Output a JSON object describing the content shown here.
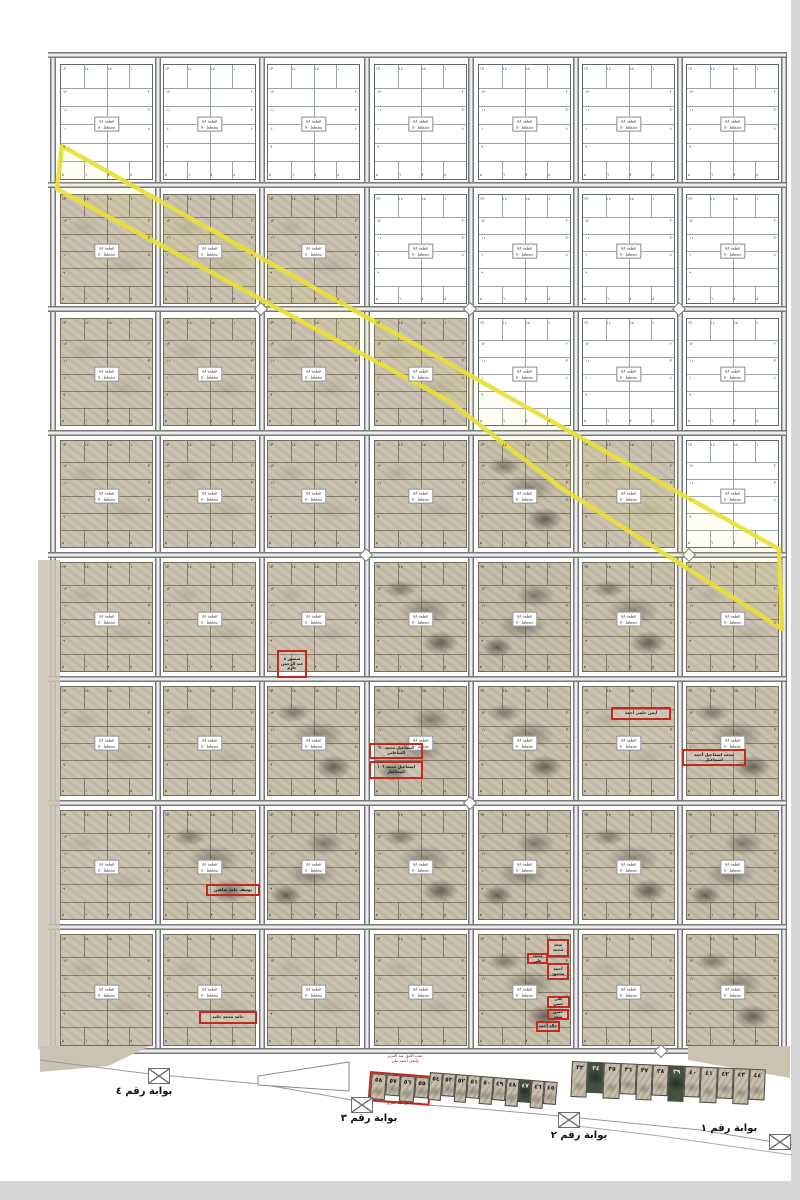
{
  "grid": {
    "rows": 8,
    "cols": 7,
    "states": [
      "wwwwwww",
      "tttwwww",
      "ttttwww",
      "ttttdtw",
      "tttdddt",
      "ttdddtd",
      "tdddddd",
      "ttttdtd"
    ]
  },
  "block_label": {
    "line1": "قطعة ٥٨",
    "line2": "مخطط ٥٠"
  },
  "block_numbers": {
    "top": [
      "١٣",
      "١٤",
      "١٥",
      "١"
    ],
    "left": [
      "١٢",
      "١١",
      "١٠",
      "٩"
    ],
    "right": [
      "٢",
      "٣",
      "٤",
      ""
    ],
    "bottom": [
      "٥",
      "٦",
      "٧",
      "٨"
    ]
  },
  "red_tags": [
    {
      "x": 277,
      "y": 650,
      "w": 30,
      "h": 28,
      "lines": [
        "منصور ٨",
        "عبد الرحمن",
        "حازم"
      ]
    },
    {
      "x": 369,
      "y": 743,
      "w": 54,
      "h": 16,
      "lines": [
        "اسماعيل محمد ٦٠",
        "الساعاتي"
      ]
    },
    {
      "x": 369,
      "y": 761,
      "w": 54,
      "h": 18,
      "lines": [
        "اسماعيل محمد ١٠٦",
        "اسماعيل"
      ]
    },
    {
      "x": 611,
      "y": 707,
      "w": 60,
      "h": 13,
      "lines": [
        "أيمن حلمي أحمد"
      ]
    },
    {
      "x": 682,
      "y": 749,
      "w": 64,
      "h": 17,
      "lines": [
        "محمد اسماعيل أحمد",
        "اسماعيل"
      ]
    },
    {
      "x": 206,
      "y": 884,
      "w": 54,
      "h": 12,
      "lines": [
        "يوسف حامد شاهين"
      ]
    },
    {
      "x": 199,
      "y": 1011,
      "w": 58,
      "h": 13,
      "lines": [
        "حامد محمد حامد"
      ]
    },
    {
      "x": 547,
      "y": 939,
      "w": 22,
      "h": 18,
      "lines": [
        "سعد",
        "محمد"
      ]
    },
    {
      "x": 527,
      "y": 953,
      "w": 21,
      "h": 11,
      "lines": [
        "محمد علي"
      ]
    },
    {
      "x": 547,
      "y": 963,
      "w": 22,
      "h": 17,
      "lines": [
        "أحمد",
        "محمود"
      ]
    },
    {
      "x": 547,
      "y": 996,
      "w": 23,
      "h": 12,
      "lines": [
        "علي حسن"
      ]
    },
    {
      "x": 547,
      "y": 1009,
      "w": 22,
      "h": 11,
      "lines": [
        "حسن سعد"
      ]
    },
    {
      "x": 536,
      "y": 1021,
      "w": 24,
      "h": 11,
      "lines": [
        "خالد أحمد"
      ]
    }
  ],
  "gates": [
    {
      "label": "بوابة رقم ٤",
      "icon_x": 148,
      "icon_y": 1068,
      "label_x": 105,
      "label_y": 1086
    },
    {
      "label": "بوابة رقم ٣",
      "icon_x": 351,
      "icon_y": 1097,
      "label_x": 330,
      "label_y": 1113
    },
    {
      "label": "بوابة رقم ٢",
      "icon_x": 558,
      "icon_y": 1112,
      "label_x": 540,
      "label_y": 1130
    },
    {
      "label": "بوابة رقم ١",
      "icon_x": 769,
      "icon_y": 1134,
      "label_x": 690,
      "label_y": 1123
    }
  ],
  "diamonds": [
    [
      261,
      309
    ],
    [
      470,
      309
    ],
    [
      679,
      309
    ],
    [
      366,
      555
    ],
    [
      689,
      555
    ],
    [
      470,
      803
    ],
    [
      661,
      1051
    ]
  ],
  "overlay": {
    "yellow_points": "62,146 779,549 782,629 560,487 449,401 57,189",
    "yellow_color": "#e9e138",
    "boundary1": "40,1060 150,1074 260,1084 352,1100 470,1108 560,1116 700,1130 792,1145",
    "boundary2": "560,1124 660,1136 792,1155",
    "trapezoid": "258,1076 349,1062 349,1091 258,1085",
    "wedge_left": "40,1046 150,1046 108,1066 40,1072",
    "wedge_right": "688,1046 790,1046 790,1078 688,1060",
    "left_bleed": {
      "x": 38,
      "y": 560,
      "w": 22,
      "h": 490
    }
  },
  "bottom_strip": {
    "caption_top": [
      "عبده الحق عبد العزيز",
      "وأيمن أحمد علي"
    ],
    "caption_bottom": "عبده الحق عبد العزيز",
    "red_group": [
      "٥٨",
      "٥٧",
      "٥٦",
      "٥٥"
    ],
    "left_cells": [
      "٥٤",
      "٥٣",
      "٥٢",
      "٥١",
      "٥٠",
      "٤٩",
      "٤٨",
      "٤٧",
      "٤٦",
      "٤٥"
    ],
    "right_cells": [
      "٣٣",
      "٣٤",
      "٣٥",
      "٣٦",
      "٣٧",
      "٣٨",
      "٣٩",
      "٤٠",
      "٤١",
      "٤٢",
      "٤٣",
      "٤٤"
    ],
    "left_dark": [
      "٤٧"
    ],
    "right_dark": [
      "٣٤",
      "٣٩"
    ]
  },
  "colors": {
    "tan": "#cbc2b1",
    "road": "#8f8f8f",
    "red": "#c4281f",
    "yellow": "#e9e138"
  }
}
